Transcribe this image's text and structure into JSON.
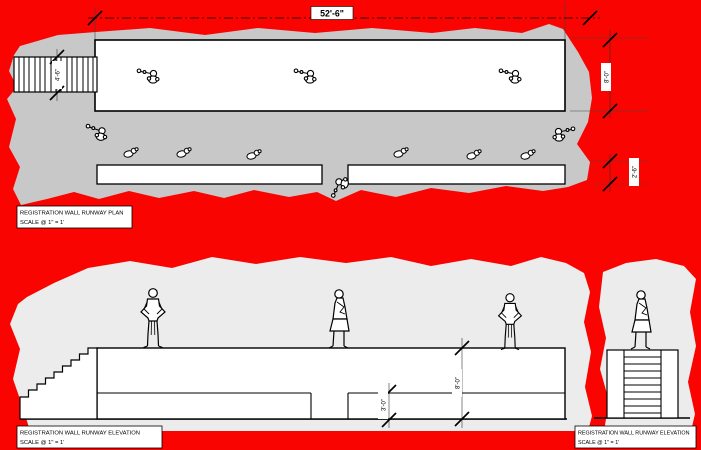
{
  "drawing": {
    "plan": {
      "dim_length": "52'-6\"",
      "dim_stair_width": "4'-6\"",
      "dim_depth": "8'-0\"",
      "dim_bench_depth": "2'-6\"",
      "label_title": "REGISTRATION WALL RUNWAY PLAN",
      "label_scale": "SCALE @  1\" = 1'"
    },
    "elevation": {
      "dim_height": "8'-0\"",
      "dim_bench_height": "3'-0\"",
      "label_title": "REGISTRATION WALL RUNWAY ELEVATION",
      "label_scale": "SCALE @  1\" = 1'",
      "label_right_title": "REGISTRATION WALL RUNWAY ELEVATION",
      "label_right_scale": "SCALE @  1\" = 1'"
    },
    "colors": {
      "canvas": "#f90400",
      "plan_area": "#c8c8c8",
      "elevation_area": "#ececec",
      "ink": "#000000",
      "paper": "#ffffff"
    }
  }
}
